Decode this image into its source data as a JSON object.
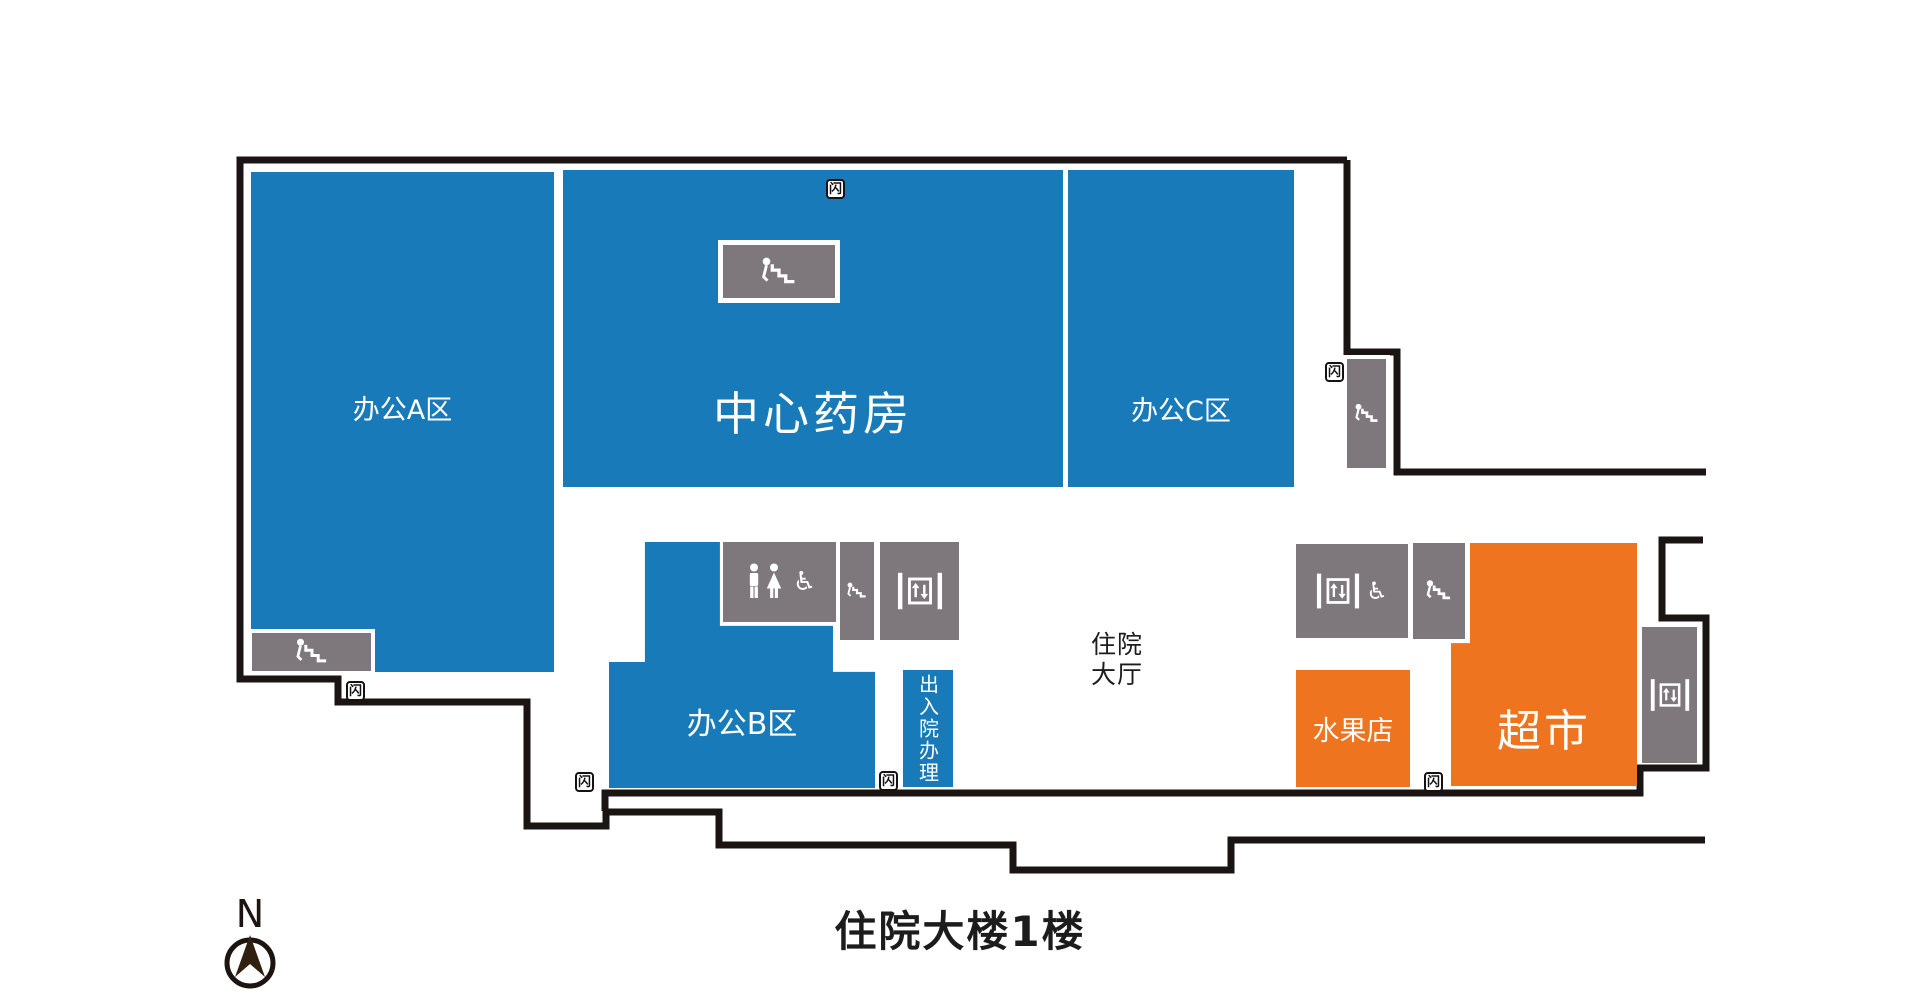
{
  "title": {
    "text": "住院大楼1楼"
  },
  "compass": {
    "letter": "N"
  },
  "colors": {
    "blue": "#187ab8",
    "orange": "#ef741f",
    "gray": "#7e777b",
    "wall": "#1a1412",
    "ink": "#1c1c1c"
  },
  "rooms": {
    "office_a": {
      "label": "办公A区"
    },
    "pharmacy": {
      "label": "中心药房"
    },
    "office_c": {
      "label": "办公C区"
    },
    "office_b": {
      "label": "办公B区"
    },
    "admission": {
      "label": "出入院办理"
    },
    "hall": {
      "label": "住院\n大厅"
    },
    "fruit_shop": {
      "label": "水果店"
    },
    "supermarket": {
      "label": "超市"
    }
  },
  "icons": {
    "exit_marker_glyph": "闪",
    "wheelchair_glyph": "♿",
    "stairs": "stairs-icon",
    "elevator": "elevator-icon",
    "toilet": "toilet-icon"
  }
}
